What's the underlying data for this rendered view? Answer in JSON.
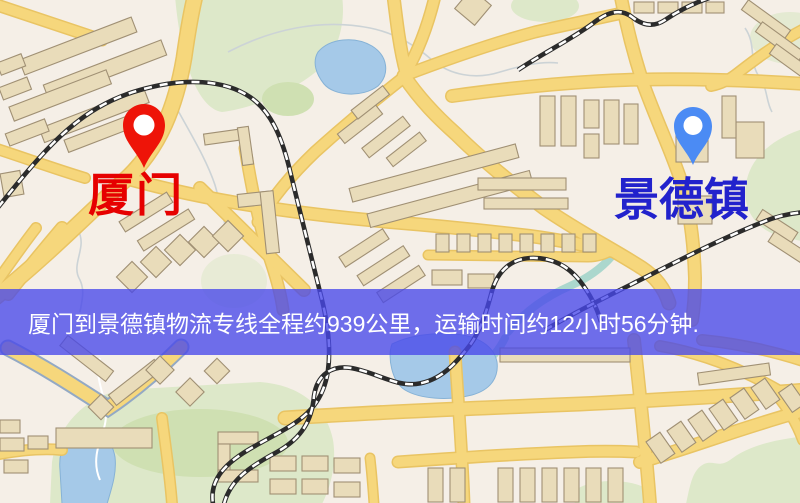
{
  "map_image": {
    "origin": {
      "label": "厦门",
      "pin_color": "#ee1408",
      "label_color": "#e60000",
      "pin_position": {
        "x": 144,
        "y": 168
      }
    },
    "destination": {
      "label": "景德镇",
      "pin_color": "#4b8bf4",
      "label_color": "#2222cc",
      "pin_position": {
        "x": 693,
        "y": 165
      }
    },
    "info_banner": {
      "text": "厦门到景德镇物流专线全程约939公里，运输时间约12小时56分钟.",
      "distance_km": 939,
      "duration_hours": 12,
      "duration_minutes": 56,
      "text_color": "#ffffff",
      "background_color": "rgba(72,72,235,0.78)"
    },
    "palette": {
      "bg": "#f5efe7",
      "road": "#f6d77c",
      "road-casing": "#e9c463",
      "highway-casing": "#93a9c4",
      "building": "#e9dcba",
      "building-stroke": "#a09074",
      "park": "#dde8c9",
      "park-dark": "#cfe0b2",
      "water": "#a5c9e8",
      "rail": "#2b2b2b",
      "stream": "#ccd3d6",
      "river": "#9ed2c8"
    }
  }
}
